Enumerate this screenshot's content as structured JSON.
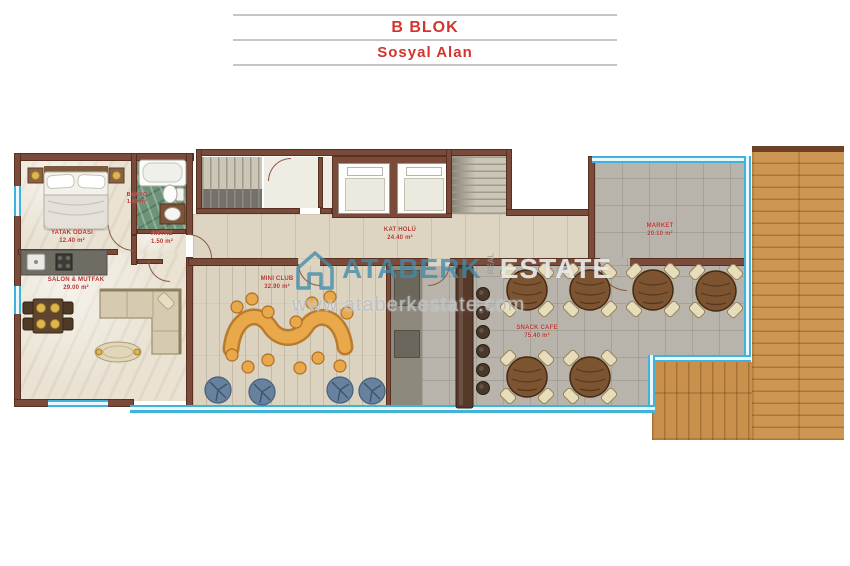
{
  "title": {
    "line1": "B BLOK",
    "line2": "Sosyal Alan"
  },
  "rooms": {
    "bedroom": {
      "name": "YATAK ODASI",
      "area": "12.40 m²"
    },
    "bathroom": {
      "name": "BANYO",
      "area": "1.20 m²"
    },
    "entry": {
      "name": "ANTRE",
      "area": "1.50 m²"
    },
    "living_kitchen": {
      "name": "SALON & MUTFAK",
      "area": "29.00 m²"
    },
    "floor_hall": {
      "name": "KAT HOLÜ",
      "area": "24.40 m²"
    },
    "mini_club": {
      "name": "MINI CLUB",
      "area": "32.90 m²"
    },
    "snack_cafe": {
      "name": "SNACK CAFE",
      "area": "75.40 m²"
    },
    "market": {
      "name": "MARKET",
      "area": "20.10 m²"
    }
  },
  "watermark": {
    "brand_primary": "ATABERK",
    "brand_middle": "REAL",
    "brand_secondary": "ESTATE",
    "website": "www.ataberkestate.com"
  },
  "colors": {
    "accent_red": "#d4342e",
    "label_red": "#b5342c",
    "wall_brown": "#7a4a3b",
    "glass_cyan": "#3fb3d9",
    "watermark_blue": "#408caa",
    "deck_wood": "#cd9753"
  }
}
